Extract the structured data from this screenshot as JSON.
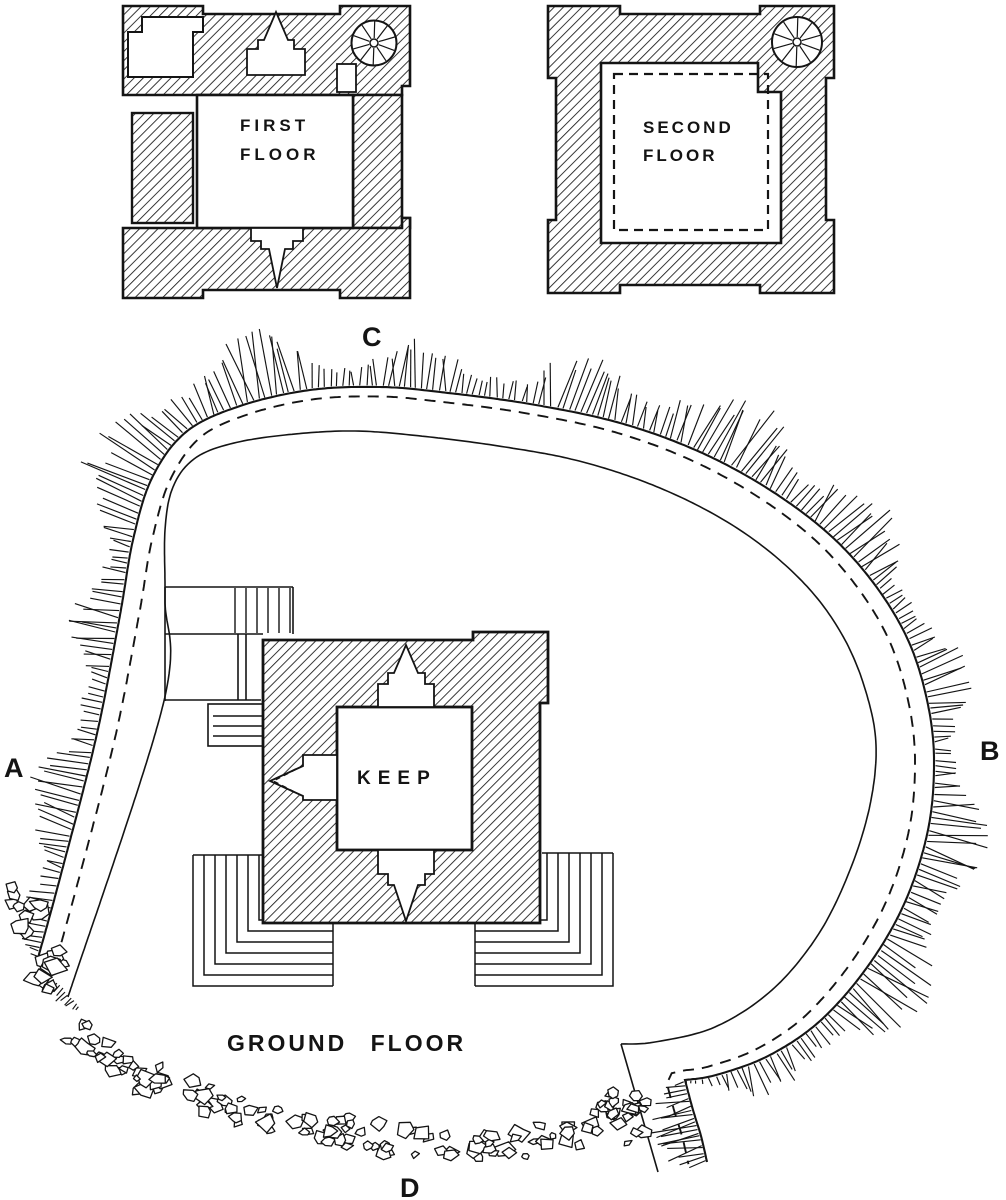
{
  "figure": {
    "plans": {
      "first_floor": {
        "label_line1": "FIRST",
        "label_line2": "FLOOR"
      },
      "second_floor": {
        "label_line1": "SECOND",
        "label_line2": "FLOOR"
      },
      "ground_floor": {
        "keep_label": "KEEP",
        "caption": "GROUND FLOOR"
      }
    },
    "section_markers": {
      "left": "A",
      "right": "B",
      "top": "C",
      "bottom": "D"
    },
    "colors": {
      "ink": "#141414",
      "paper": "#ffffff"
    }
  }
}
